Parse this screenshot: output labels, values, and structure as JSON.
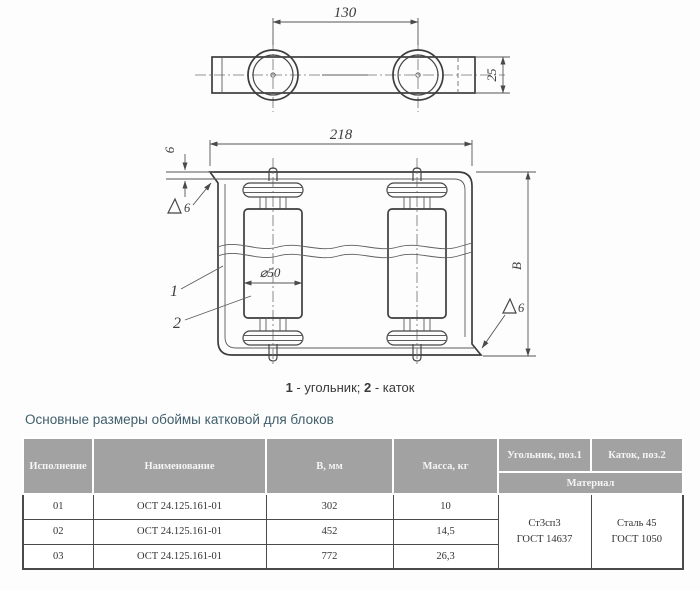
{
  "drawing": {
    "top_view": {
      "dim_centers": "130",
      "dim_width": "25"
    },
    "front_view": {
      "dim_overall": "218",
      "dim_thickness": "6",
      "dim_diameter": "⌀50",
      "dim_height": "В",
      "weld_size_left": "6",
      "weld_size_right": "6",
      "pos1": "1",
      "pos2": "2"
    },
    "caption": {
      "pos1": "1",
      "pos1_label": " - угольник; ",
      "pos2": "2",
      "pos2_label": " - каток"
    }
  },
  "section_title": "Основные размеры обоймы катковой для блоков",
  "table": {
    "headers": {
      "col1": "Исполнение",
      "col2": "Наименование",
      "col3": "В, мм",
      "col4": "Масса, кг",
      "col5": "Угольник, поз.1",
      "col6": "Каток, поз.2",
      "material": "Материал"
    },
    "rows": [
      {
        "version": "01",
        "name": "ОСТ 24.125.161-01",
        "b_mm": "302",
        "mass_kg": "10"
      },
      {
        "version": "02",
        "name": "ОСТ 24.125.161-01",
        "b_mm": "452",
        "mass_kg": "14,5"
      },
      {
        "version": "03",
        "name": "ОСТ 24.125.161-01",
        "b_mm": "772",
        "mass_kg": "26,3"
      }
    ],
    "materials": {
      "ugolnik_line1": "Ст3сп3",
      "ugolnik_line2": "ГОСТ 14637",
      "katok_line1": "Сталь 45",
      "katok_line2": "ГОСТ 1050"
    }
  },
  "colors": {
    "title_text": "#3f5e6b",
    "header_bg": "#a2a2a2",
    "header_text": "#f4f4f4",
    "table_border": "#4a4a4a",
    "drawing_line": "#3d3d3d"
  }
}
